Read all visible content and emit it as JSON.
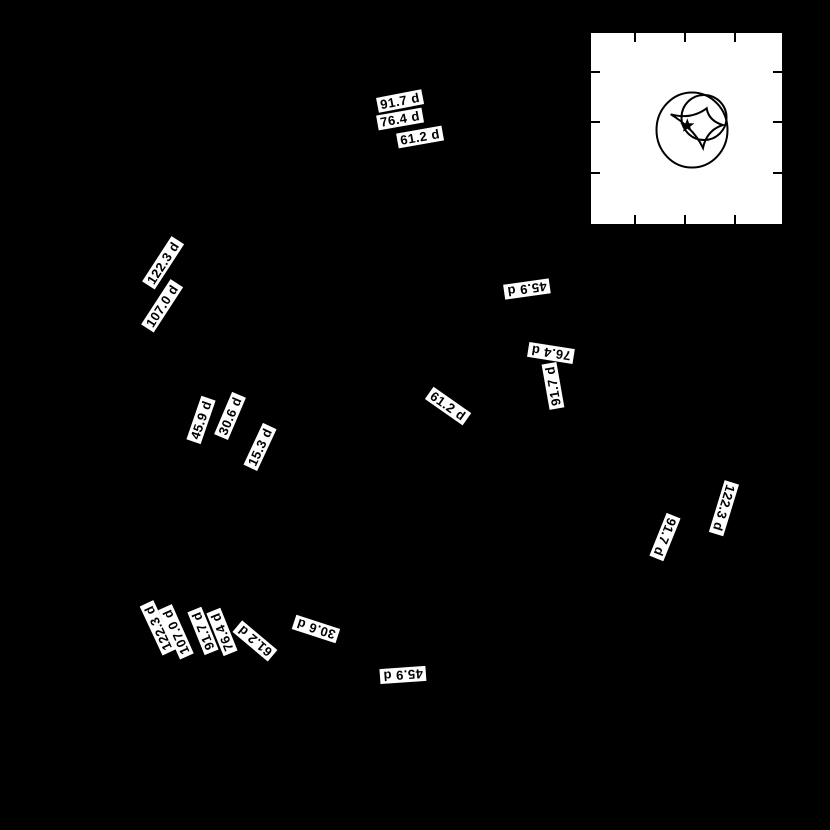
{
  "figure": {
    "background_color": "#000000",
    "label_text_color": "#000000",
    "label_box_color": "#ffffff",
    "line_color": "#000000"
  },
  "chart_data": {
    "type": "contour",
    "title": "",
    "xlabel": "",
    "ylabel": "",
    "unit": "d",
    "contour_levels_days": [
      15.3,
      30.6,
      45.9,
      61.2,
      76.4,
      91.7,
      107.0,
      122.3
    ],
    "labels": [
      {
        "text": "91.7 d",
        "x": 400,
        "y": 101,
        "rot": -11
      },
      {
        "text": "76.4 d",
        "x": 400,
        "y": 119,
        "rot": -10
      },
      {
        "text": "61.2 d",
        "x": 420,
        "y": 137,
        "rot": -10
      },
      {
        "text": "122.3 d",
        "x": 163,
        "y": 263,
        "rot": -57
      },
      {
        "text": "107.0 d",
        "x": 162,
        "y": 306,
        "rot": -57
      },
      {
        "text": "45.9 d",
        "x": 201,
        "y": 420,
        "rot": -71
      },
      {
        "text": "30.6 d",
        "x": 230,
        "y": 416,
        "rot": -67
      },
      {
        "text": "15.3 d",
        "x": 260,
        "y": 447,
        "rot": -65
      },
      {
        "text": "45.9 d",
        "x": 527,
        "y": 289,
        "rot": 172
      },
      {
        "text": "76.4 d",
        "x": 551,
        "y": 353,
        "rot": 189
      },
      {
        "text": "91.7 d",
        "x": 553,
        "y": 386,
        "rot": -100
      },
      {
        "text": "61.2 d",
        "x": 448,
        "y": 406,
        "rot": 35
      },
      {
        "text": "122.3 d",
        "x": 724,
        "y": 508,
        "rot": 107
      },
      {
        "text": "91.7 d",
        "x": 665,
        "y": 537,
        "rot": 112
      },
      {
        "text": "122.3 d",
        "x": 158,
        "y": 628,
        "rot": -115
      },
      {
        "text": "107.0 d",
        "x": 176,
        "y": 632,
        "rot": -114
      },
      {
        "text": "91.7 d",
        "x": 203,
        "y": 631,
        "rot": -112
      },
      {
        "text": "76.4 d",
        "x": 222,
        "y": 632,
        "rot": -112
      },
      {
        "text": "61.2 d",
        "x": 255,
        "y": 641,
        "rot": -140
      },
      {
        "text": "30.6 d",
        "x": 316,
        "y": 629,
        "rot": 198
      },
      {
        "text": "45.9 d",
        "x": 403,
        "y": 675,
        "rot": 176
      }
    ],
    "inset": {
      "x": 588,
      "y": 30,
      "width": 197,
      "height": 197,
      "background": "#ffffff",
      "frame_color": "#000000",
      "frame_width": 3,
      "tick_length": 9,
      "tick_width": 2,
      "x_ticks": [
        47,
        97,
        147
      ],
      "y_ticks": [
        42,
        92,
        143
      ],
      "large_circle": {
        "cx": 104,
        "cy": 100,
        "rx": 35.5,
        "ry": 37.5,
        "stroke": 2
      },
      "small_circle": {
        "cx": 116,
        "cy": 87.5,
        "rx": 22.5,
        "ry": 22.5,
        "stroke": 2
      },
      "caustic_path": "M 82.7 84.3 Q 103 90 118.7 78.3 Q 120.5 90.5 134.7 95 Q 118.5 100.5 115 118 Q 106 98.5 82.7 84.3 Z",
      "caustic_stroke": 2,
      "star": {
        "cx": 99.3,
        "cy": 95.7,
        "outer_r": 7.5,
        "inner_r": 3,
        "points": 5
      }
    }
  }
}
